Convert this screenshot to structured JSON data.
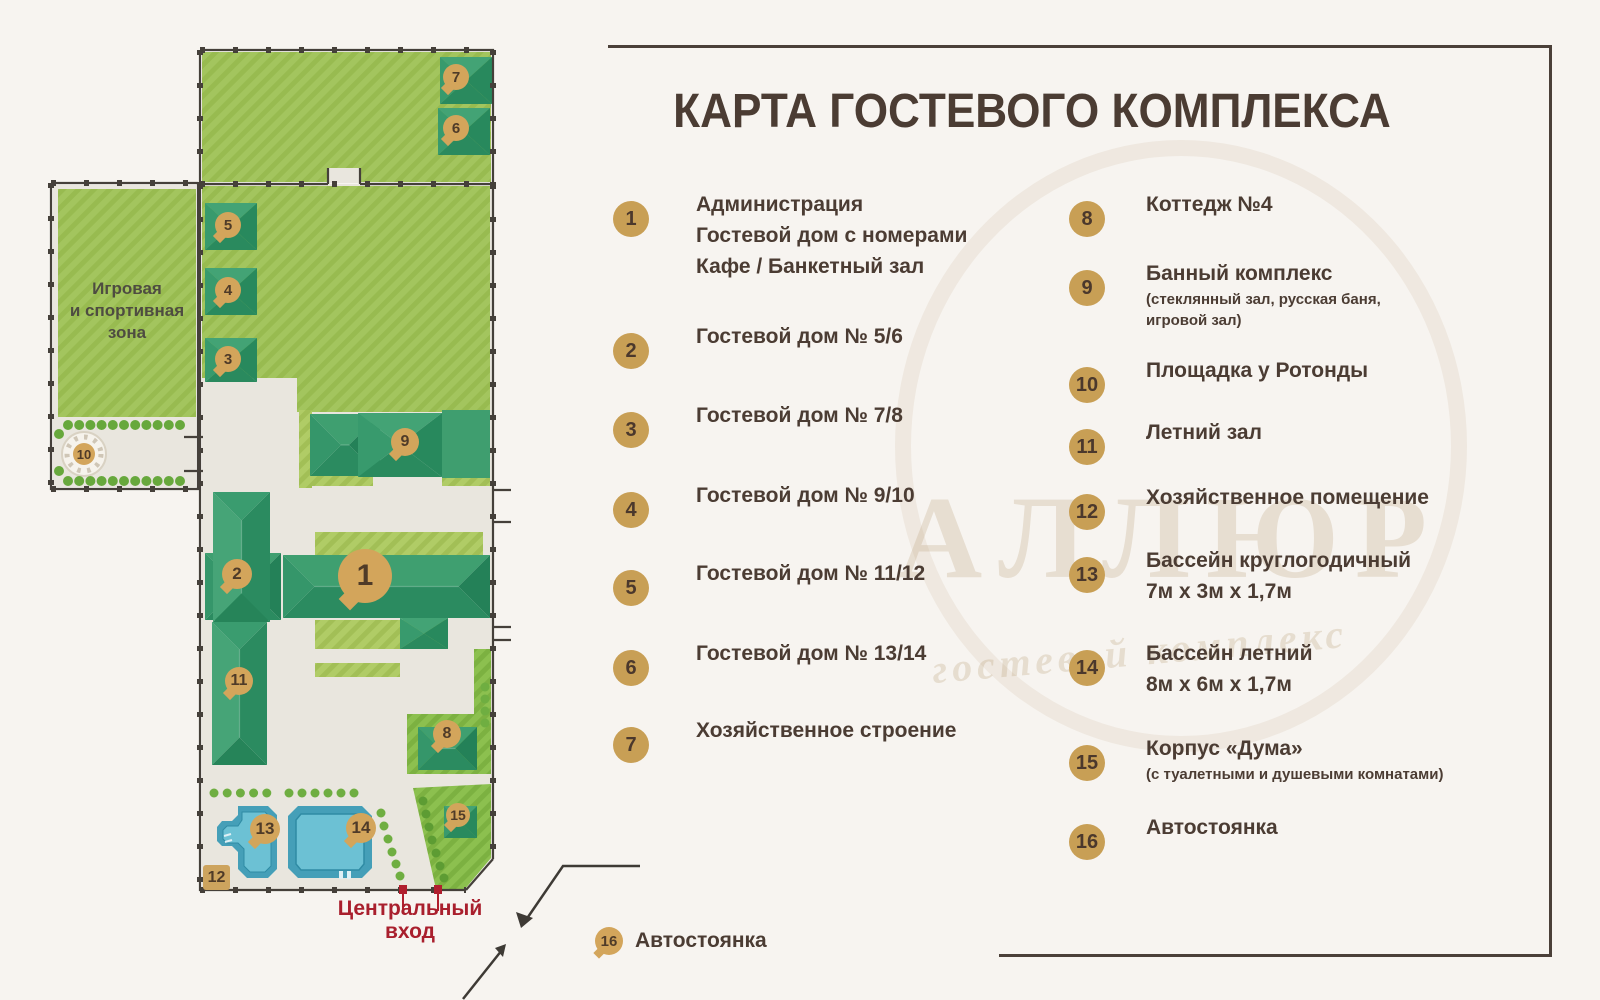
{
  "title": "КАРТА ГОСТЕВОГО КОМПЛЕКСА",
  "legend": {
    "left": [
      {
        "num": "1",
        "lines": [
          "Администрация",
          "Гостевой дом с номерами",
          "Кафе / Банкетный зал"
        ]
      },
      {
        "num": "2",
        "lines": [
          "Гостевой дом № 5/6"
        ]
      },
      {
        "num": "3",
        "lines": [
          "Гостевой дом № 7/8"
        ]
      },
      {
        "num": "4",
        "lines": [
          "Гостевой дом № 9/10"
        ]
      },
      {
        "num": "5",
        "lines": [
          "Гостевой дом № 11/12"
        ]
      },
      {
        "num": "6",
        "lines": [
          "Гостевой дом № 13/14"
        ]
      },
      {
        "num": "7",
        "lines": [
          "Хозяйственное строение"
        ]
      }
    ],
    "right": [
      {
        "num": "8",
        "lines": [
          "Коттедж №4"
        ]
      },
      {
        "num": "9",
        "lines": [
          "Банный комплекс"
        ],
        "note": [
          "(стеклянный зал, русская баня,",
          "игровой зал)"
        ]
      },
      {
        "num": "10",
        "lines": [
          "Площадка у Ротонды"
        ]
      },
      {
        "num": "11",
        "lines": [
          "Летний зал"
        ]
      },
      {
        "num": "12",
        "lines": [
          "Хозяйственное помещение"
        ]
      },
      {
        "num": "13",
        "lines": [
          "Бассейн круглогодичный",
          "7м х 3м х 1,7м"
        ]
      },
      {
        "num": "14",
        "lines": [
          "Бассейн летний",
          "8м х 6м х 1,7м"
        ]
      },
      {
        "num": "15",
        "lines": [
          "Корпус «Дума»"
        ],
        "note": [
          "(с туалетными и душевыми комнатами)"
        ]
      },
      {
        "num": "16",
        "lines": [
          "Автостоянка"
        ]
      }
    ]
  },
  "map": {
    "zone_lines": [
      "Игровая",
      "и спортивная",
      "зона"
    ],
    "entrance_lines": [
      "Центральный",
      "вход"
    ],
    "corner_badge": "12",
    "parking": {
      "num": "16",
      "label": "Автостоянка"
    },
    "markers": [
      {
        "num": "1",
        "x": 365,
        "y": 576,
        "r": 27,
        "tail": true,
        "fs": 30
      },
      {
        "num": "2",
        "x": 237,
        "y": 574,
        "r": 15,
        "tail": true,
        "fs": 17
      },
      {
        "num": "3",
        "x": 228,
        "y": 359,
        "r": 13,
        "tail": true,
        "fs": 15
      },
      {
        "num": "4",
        "x": 228,
        "y": 290,
        "r": 13,
        "tail": true,
        "fs": 15
      },
      {
        "num": "5",
        "x": 228,
        "y": 225,
        "r": 13,
        "tail": true,
        "fs": 15
      },
      {
        "num": "6",
        "x": 456,
        "y": 128,
        "r": 13,
        "tail": true,
        "fs": 15
      },
      {
        "num": "7",
        "x": 456,
        "y": 77,
        "r": 13,
        "tail": true,
        "fs": 15
      },
      {
        "num": "8",
        "x": 447,
        "y": 734,
        "r": 14,
        "tail": true,
        "fs": 16
      },
      {
        "num": "9",
        "x": 405,
        "y": 442,
        "r": 14,
        "tail": true,
        "fs": 16
      },
      {
        "num": "10",
        "x": 84,
        "y": 454,
        "r": 11,
        "tail": false,
        "fs": 13
      },
      {
        "num": "11",
        "x": 239,
        "y": 681,
        "r": 14,
        "tail": true,
        "fs": 16
      },
      {
        "num": "13",
        "x": 265,
        "y": 829,
        "r": 15,
        "tail": true,
        "fs": 17
      },
      {
        "num": "14",
        "x": 361,
        "y": 828,
        "r": 15,
        "tail": true,
        "fs": 17
      },
      {
        "num": "15",
        "x": 458,
        "y": 815,
        "r": 12,
        "tail": true,
        "fs": 14
      }
    ]
  },
  "watermark": {
    "word": "АЛЛЮР",
    "script": "гостевой комплекс"
  },
  "colors": {
    "accent_gold": "#c89f55",
    "text_brown": "#4b3c33",
    "entrance_red": "#a91f2d",
    "lawn_green": "#a3c55e",
    "building_green": "#2f9064",
    "pool_blue": "#6cc1d4",
    "fence_dark": "#45403a",
    "ground": "#e9e6de"
  }
}
